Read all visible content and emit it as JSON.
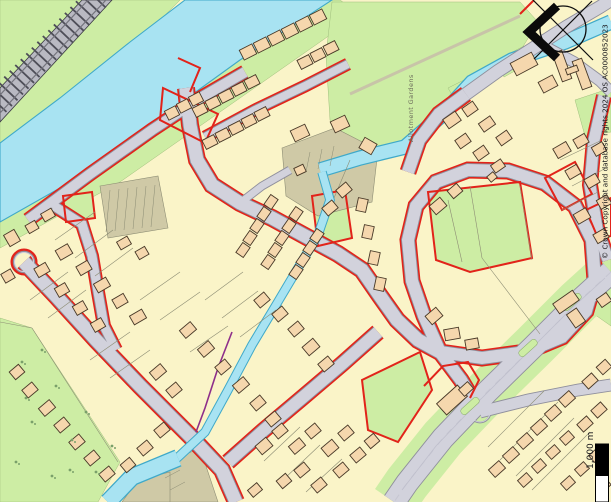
{
  "map": {
    "labels": {
      "allotment_gardens": "Allotment Gardens",
      "copyright": "© Crown Copyright and database rights 2024 OS AC0000852023",
      "scale": "1,000 m"
    },
    "icons": {
      "compass": "compass-rose-icon",
      "scale_bar": "scale-bar"
    },
    "colors": {
      "parcel": "#FAF4C8",
      "building": "#F5D7AD",
      "building_outline": "#473827",
      "road": "#D2D2DC",
      "road_edge": "#8F8F9C",
      "water": "#A8E3F2",
      "water_edge": "#3FA9C9",
      "green": "#CDEDA4",
      "khaki": "#CFC9A6",
      "red": "#E2231A",
      "railway": "#B9B9C2",
      "purple": "#8E2F8A"
    }
  }
}
